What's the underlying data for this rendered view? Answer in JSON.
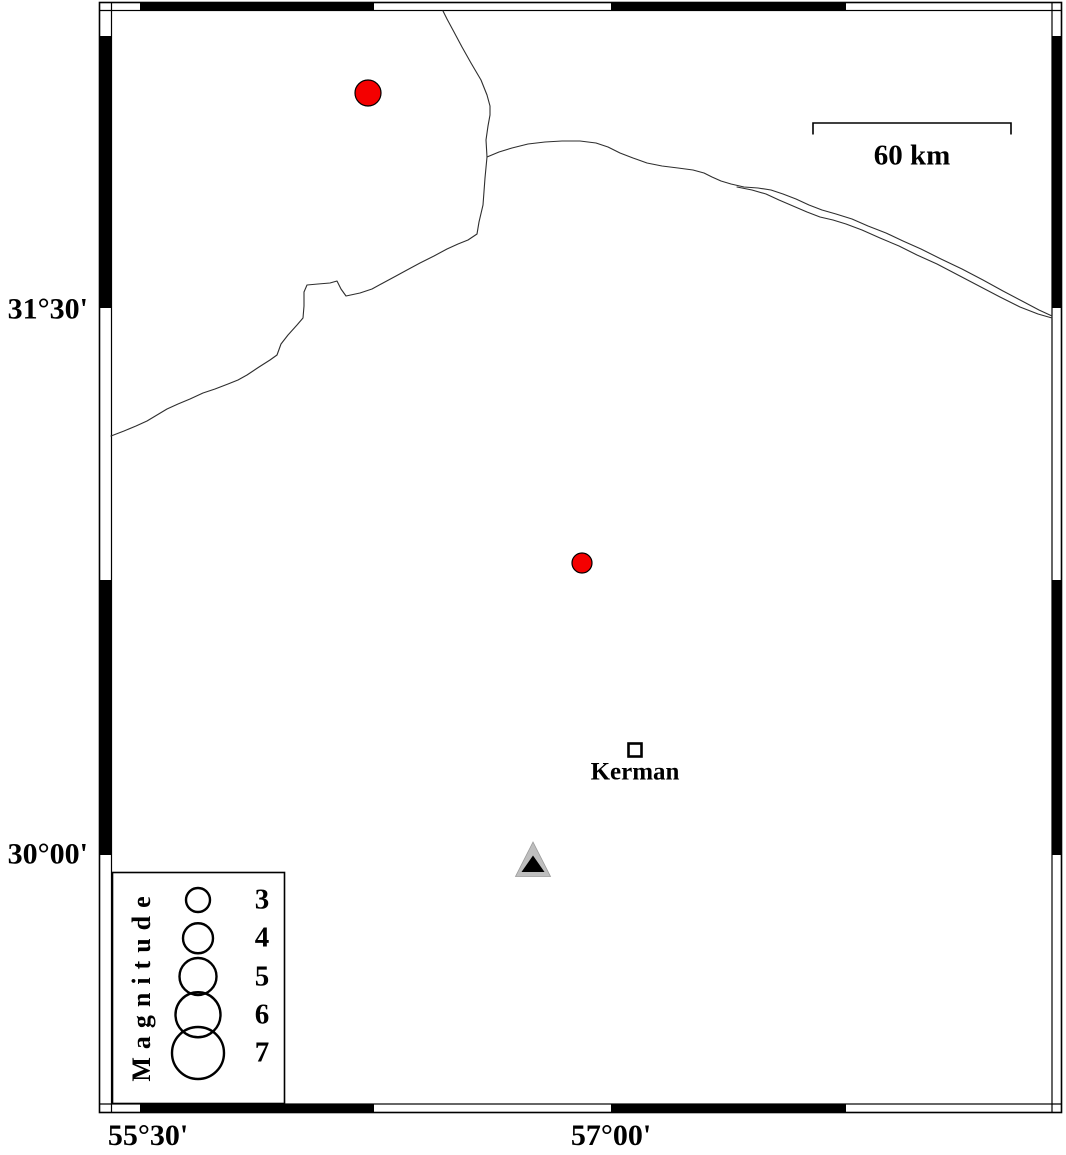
{
  "frame": {
    "left_axis_labels": [
      "31°30'",
      "30°00'"
    ],
    "bottom_axis_labels": [
      "55°30'",
      "57°00'"
    ]
  },
  "scale_bar": {
    "label": "60 km"
  },
  "city": {
    "name": "Kerman",
    "x": 635,
    "y": 750
  },
  "station": {
    "x": 533,
    "y": 860
  },
  "epicenters": [
    {
      "x": 368,
      "y": 93,
      "r": 13
    },
    {
      "x": 582,
      "y": 563,
      "r": 10
    }
  ],
  "legend": {
    "title": "Magnitude",
    "entries": [
      {
        "label": "3",
        "r": 12
      },
      {
        "label": "4",
        "r": 15
      },
      {
        "label": "5",
        "r": 18.5
      },
      {
        "label": "6",
        "r": 22.5
      },
      {
        "label": "7",
        "r": 26
      }
    ]
  },
  "colors": {
    "epicenter": "#F40000",
    "station_outer": "#BEBEBE",
    "station_inner": "#000000",
    "border_line": "#2e2e2e"
  }
}
